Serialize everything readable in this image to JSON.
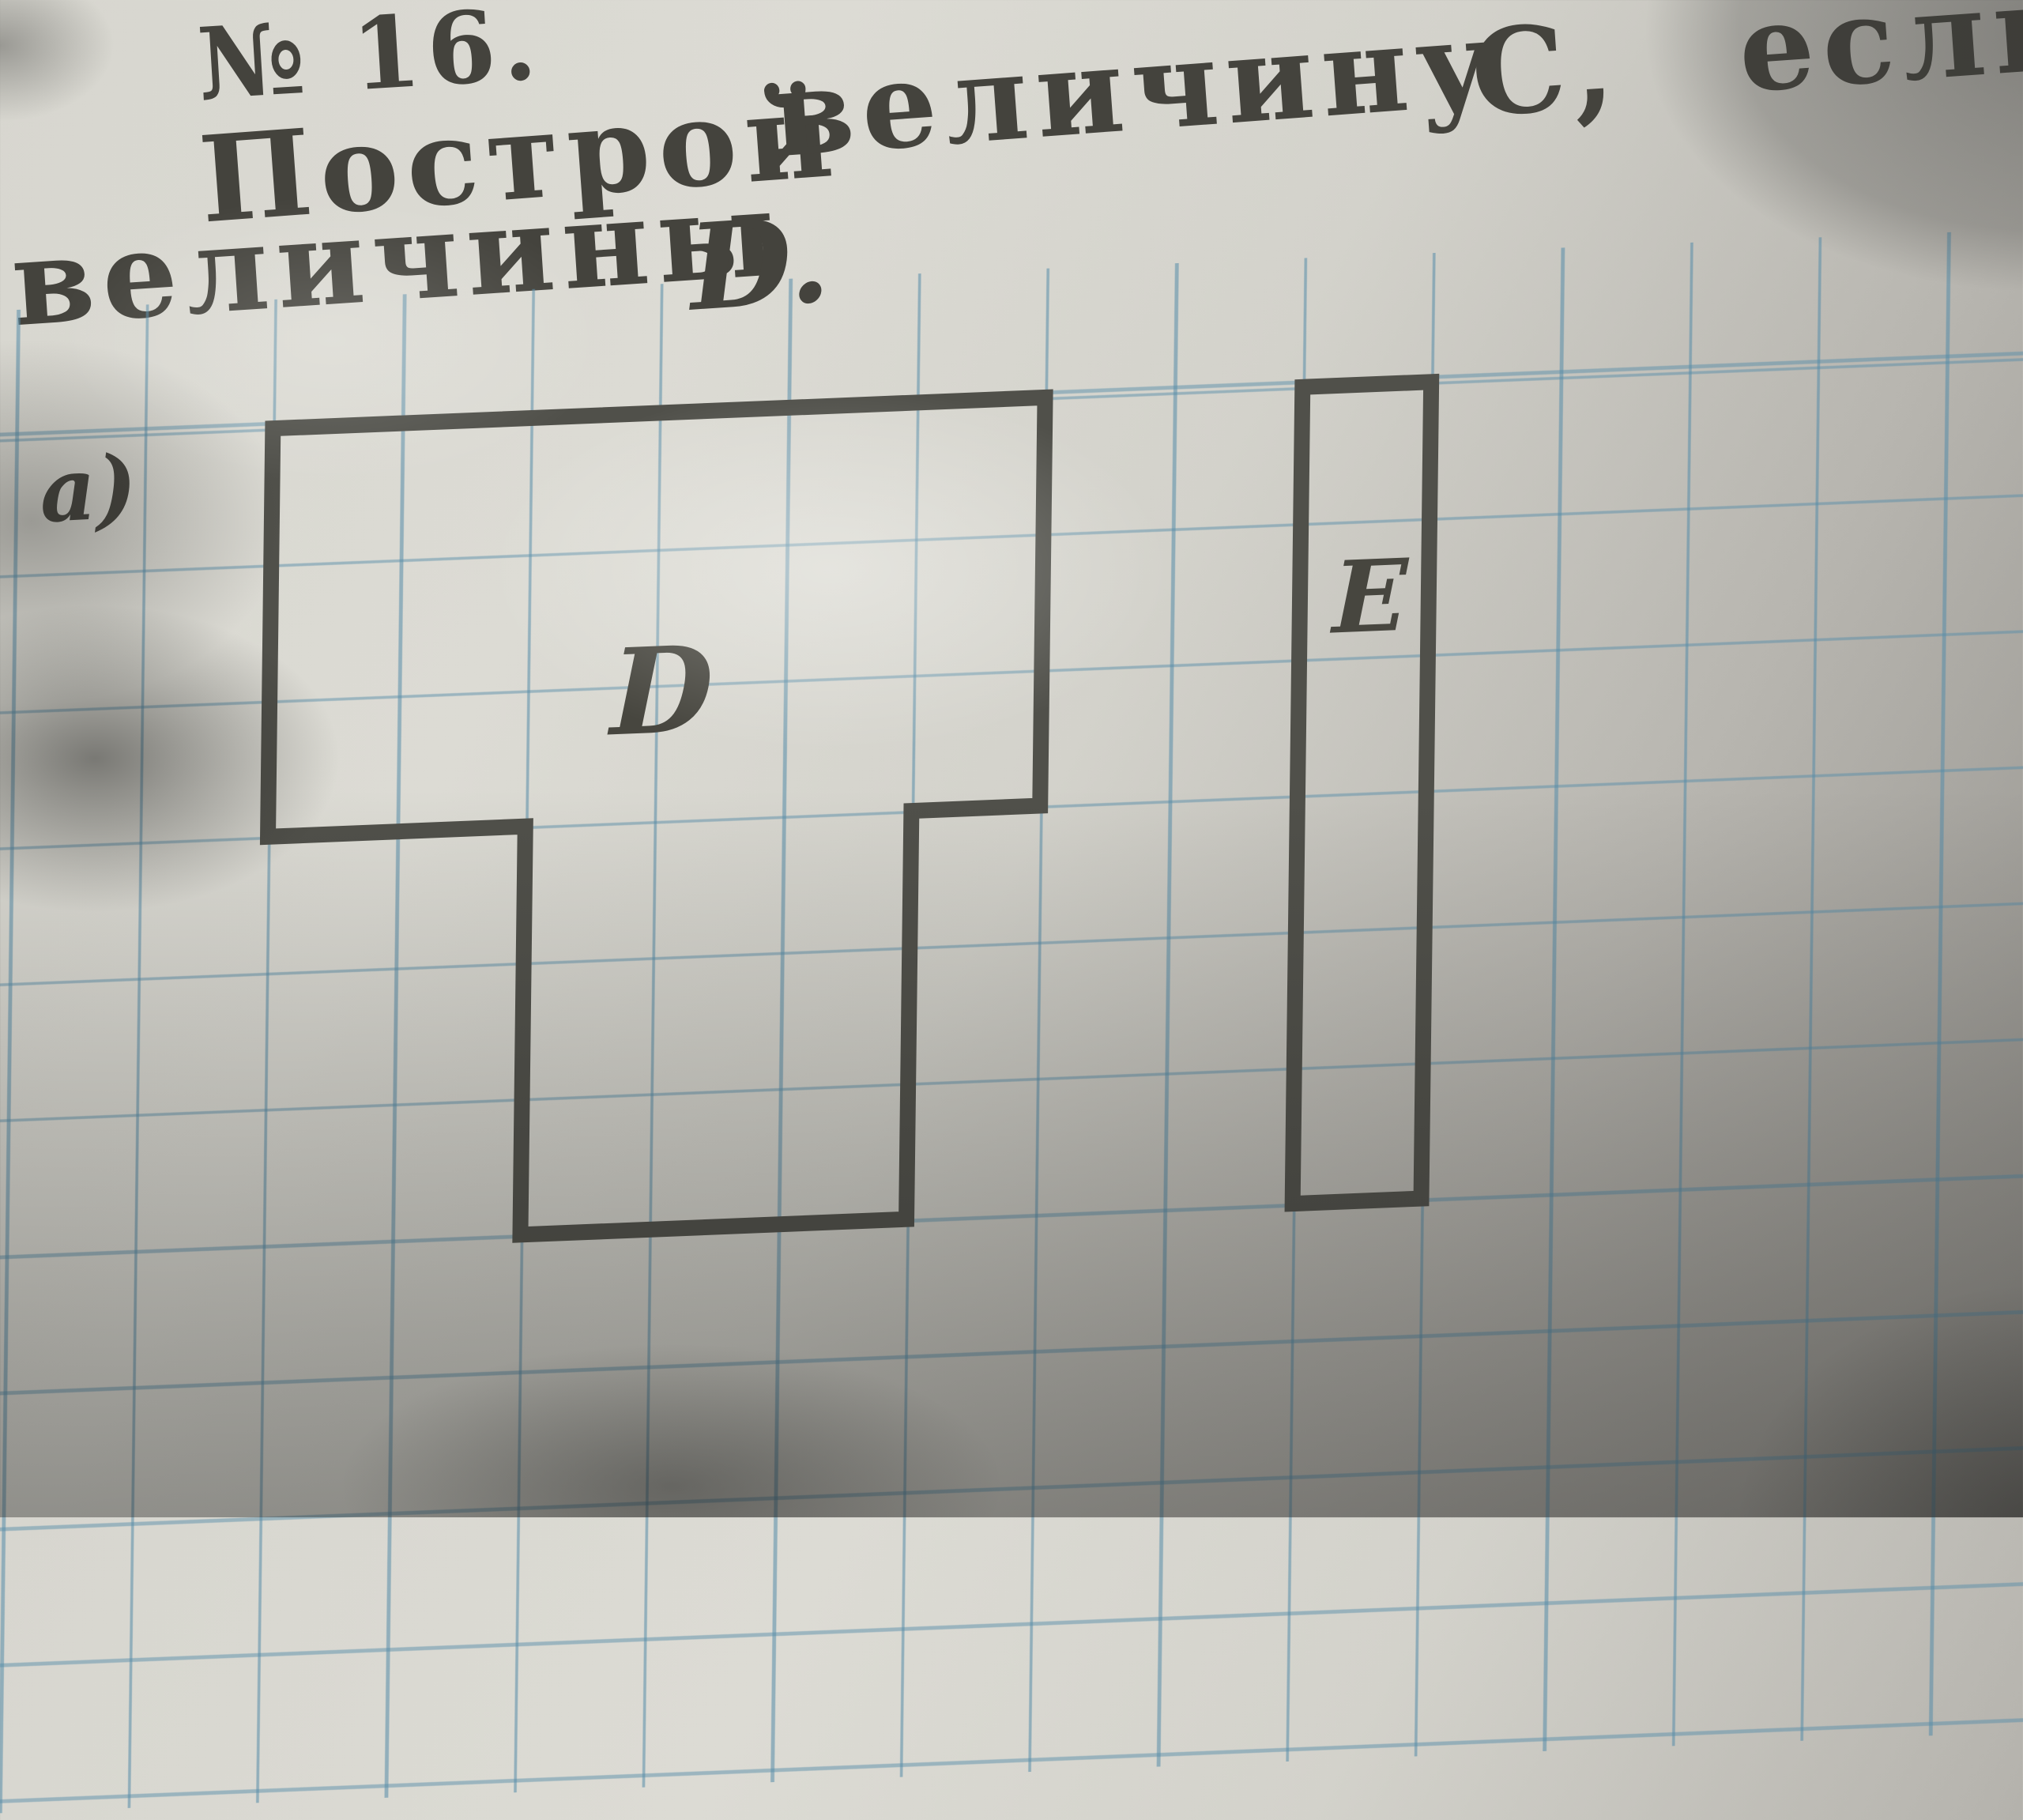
{
  "header": {
    "problem_number": "№ 16.",
    "task_line1": {
      "word1": "Построй",
      "word2": "величину",
      "word3": "С,",
      "word4": "если"
    },
    "task_line2": {
      "word1": "величины",
      "word2": "D."
    },
    "part_label": "a)"
  },
  "worksheet": {
    "grid": {
      "paper_color": "#d6d5ce",
      "grid_line_color": "#568ca8",
      "ink_color": "#50504a",
      "cell_columns_visible": 16,
      "cell_rows_visible": 10
    },
    "figure_d": {
      "label": "D",
      "top_bar_size_cells": "6 × 3",
      "stem_size_cells": "3 × 3",
      "vertices_cells": [
        [
          0,
          0
        ],
        [
          6,
          0
        ],
        [
          6,
          3
        ],
        [
          5,
          3
        ],
        [
          5,
          6
        ],
        [
          2,
          6
        ],
        [
          2,
          3
        ],
        [
          0,
          3
        ]
      ],
      "area_cells": 27
    },
    "figure_e": {
      "label": "E",
      "size_cells": "1 × 6",
      "vertices_cells": [
        [
          8,
          0
        ],
        [
          9,
          0
        ],
        [
          9,
          6
        ],
        [
          8,
          6
        ]
      ],
      "area_cells": 6
    }
  }
}
